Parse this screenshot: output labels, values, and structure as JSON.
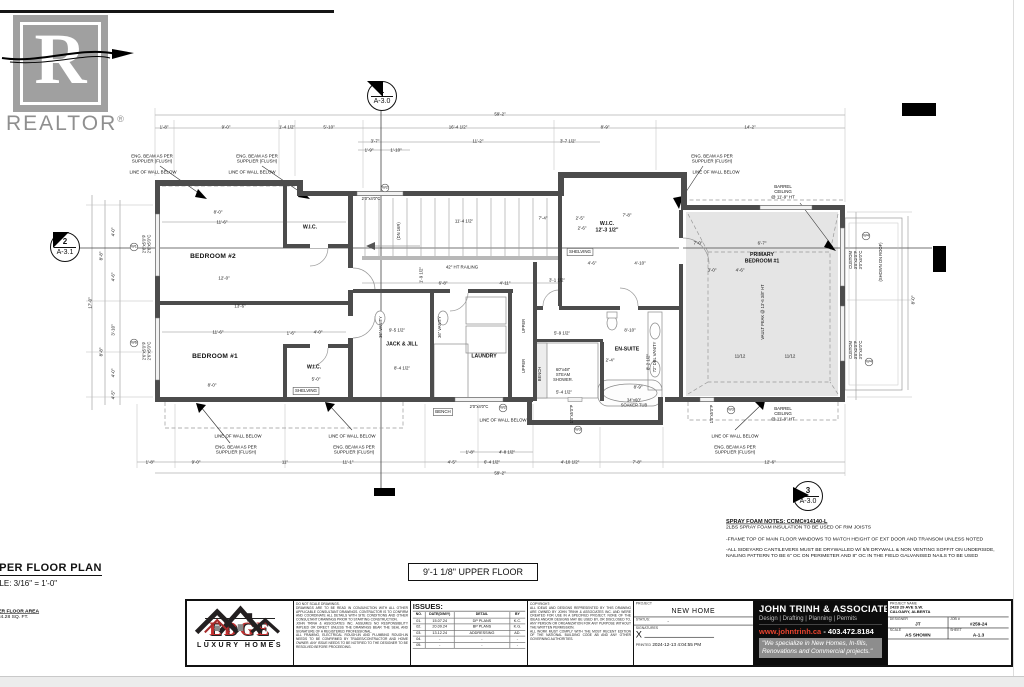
{
  "watermark": {
    "brand": "REALTOR",
    "reg": "®",
    "letter": "R"
  },
  "section_markers": [
    {
      "num": "1",
      "sheet": "A-3.0"
    },
    {
      "num": "2",
      "sheet": "A-3.1"
    },
    {
      "num": "3",
      "sheet": "A-3.0"
    }
  ],
  "plan": {
    "labels": [
      {
        "t": "59'-2\"",
        "x": 500,
        "y": 114
      },
      {
        "t": "1'-8\"",
        "x": 164,
        "y": 127
      },
      {
        "t": "9'-0\"",
        "x": 226,
        "y": 127
      },
      {
        "t": "1'-4 1/2\"",
        "x": 287,
        "y": 127
      },
      {
        "t": "5'-10\"",
        "x": 329,
        "y": 127
      },
      {
        "t": "16'-4 1/2\"",
        "x": 458,
        "y": 127
      },
      {
        "t": "8'-9\"",
        "x": 605,
        "y": 127
      },
      {
        "t": "14'-2\"",
        "x": 750,
        "y": 127
      },
      {
        "t": "3'-7\"",
        "x": 375,
        "y": 141
      },
      {
        "t": "11'-2\"",
        "x": 478,
        "y": 141
      },
      {
        "t": "3'-7 1/2\"",
        "x": 568,
        "y": 141
      },
      {
        "t": "1'-9\"",
        "x": 369,
        "y": 150
      },
      {
        "t": "1'-10\"",
        "x": 396,
        "y": 150
      },
      {
        "t": "1'-8\"",
        "x": 150,
        "y": 462
      },
      {
        "t": "9'-0\"",
        "x": 196,
        "y": 462
      },
      {
        "t": "11\"",
        "x": 285,
        "y": 462
      },
      {
        "t": "11'-1\"",
        "x": 348,
        "y": 462
      },
      {
        "t": "4'-5\"",
        "x": 452,
        "y": 462
      },
      {
        "t": "6'-4 1/2\"",
        "x": 492,
        "y": 462
      },
      {
        "t": "4'-10 1/2\"",
        "x": 570,
        "y": 462
      },
      {
        "t": "7'-8\"",
        "x": 637,
        "y": 462
      },
      {
        "t": "12'-6\"",
        "x": 770,
        "y": 462
      },
      {
        "t": "1'-8\"",
        "x": 470,
        "y": 452
      },
      {
        "t": "4'-8 1/2\"",
        "x": 507,
        "y": 452
      },
      {
        "t": "59'-2\"",
        "x": 500,
        "y": 473
      },
      {
        "t": "4'-0\"",
        "x": 113,
        "y": 232,
        "r": 1
      },
      {
        "t": "8'-8\"",
        "x": 101,
        "y": 256,
        "r": 1
      },
      {
        "t": "4'-6\"",
        "x": 113,
        "y": 277,
        "r": 1
      },
      {
        "t": "17'-0\"",
        "x": 90,
        "y": 303,
        "r": 1
      },
      {
        "t": "3'-10\"",
        "x": 113,
        "y": 330,
        "r": 1
      },
      {
        "t": "8'-8\"",
        "x": 101,
        "y": 352,
        "r": 1
      },
      {
        "t": "4'-0\"",
        "x": 113,
        "y": 373,
        "r": 1
      },
      {
        "t": "4'-5\"",
        "x": 113,
        "y": 395,
        "r": 1
      },
      {
        "t": "8'-0\"",
        "x": 913,
        "y": 300,
        "r": 1
      },
      {
        "t": "8'-0\"",
        "x": 218,
        "y": 212
      },
      {
        "t": "11'-6\"",
        "x": 222,
        "y": 222
      },
      {
        "t": "12'-0\"",
        "x": 224,
        "y": 278
      },
      {
        "t": "13'-6\"",
        "x": 240,
        "y": 306
      },
      {
        "t": "11'-6\"",
        "x": 218,
        "y": 332
      },
      {
        "t": "8'-0\"",
        "x": 212,
        "y": 385
      },
      {
        "t": "1'-6\"",
        "x": 291,
        "y": 333
      },
      {
        "t": "4'-0\"",
        "x": 318,
        "y": 332
      },
      {
        "t": "5'-0\"",
        "x": 316,
        "y": 379
      },
      {
        "t": "11'-4 1/2\"",
        "x": 464,
        "y": 221
      },
      {
        "t": "7'-4\"",
        "x": 543,
        "y": 218
      },
      {
        "t": "2'-5\"",
        "x": 580,
        "y": 218
      },
      {
        "t": "2'-6\"",
        "x": 582,
        "y": 228
      },
      {
        "t": "6'-8\"",
        "x": 443,
        "y": 283
      },
      {
        "t": "4'-11\"",
        "x": 505,
        "y": 283
      },
      {
        "t": "3'-1 1/2\"",
        "x": 557,
        "y": 280
      },
      {
        "t": "1'-9 1/2\"",
        "x": 421,
        "y": 275,
        "r": 1
      },
      {
        "t": "9'-5 1/2\"",
        "x": 397,
        "y": 330
      },
      {
        "t": "8'-4 1/2\"",
        "x": 402,
        "y": 368
      },
      {
        "t": "7'-8\"",
        "x": 627,
        "y": 215
      },
      {
        "t": "4'-6\"",
        "x": 592,
        "y": 263
      },
      {
        "t": "4'-10\"",
        "x": 640,
        "y": 263
      },
      {
        "t": "5'-9 1/2\"",
        "x": 562,
        "y": 333
      },
      {
        "t": "8'-10\"",
        "x": 630,
        "y": 330
      },
      {
        "t": "2'-4\"",
        "x": 610,
        "y": 360
      },
      {
        "t": "8'-9\"",
        "x": 638,
        "y": 387
      },
      {
        "t": "5'-4 1/2\"",
        "x": 564,
        "y": 392
      },
      {
        "t": "8'-2 1/2\"",
        "x": 648,
        "y": 362,
        "r": 1
      },
      {
        "t": "7'-0\"",
        "x": 698,
        "y": 243
      },
      {
        "t": "6'-7\"",
        "x": 762,
        "y": 243
      },
      {
        "t": "3'-0\"",
        "x": 712,
        "y": 270
      },
      {
        "t": "4'-6\"",
        "x": 740,
        "y": 270
      },
      {
        "t": "11/12",
        "x": 740,
        "y": 356
      },
      {
        "t": "11/12",
        "x": 790,
        "y": 356
      },
      {
        "t": "2'6\"x5'0\"P\n2'6\"x5'0\"C",
        "x": 147,
        "y": 244,
        "k": "win",
        "r": 1
      },
      {
        "t": "2'6\"x5'0\"P\n2'6\"x5'0\"C",
        "x": 147,
        "y": 351,
        "k": "win",
        "r": 1
      },
      {
        "t": "W1",
        "x": 134,
        "y": 247,
        "k": "wc"
      },
      {
        "t": "W6",
        "x": 134,
        "y": 343,
        "k": "wc"
      },
      {
        "t": "2'0\"x4'0\"C",
        "x": 371,
        "y": 199,
        "k": "win"
      },
      {
        "t": "W2",
        "x": 385,
        "y": 188,
        "k": "wc"
      },
      {
        "t": "2'0\"x4'0\"C",
        "x": 479,
        "y": 407,
        "k": "win"
      },
      {
        "t": "W2",
        "x": 503,
        "y": 408,
        "k": "wc"
      },
      {
        "t": "1'0\"x5'0\"P",
        "x": 572,
        "y": 414,
        "k": "win",
        "r": 1
      },
      {
        "t": "W3",
        "x": 578,
        "y": 430,
        "k": "wc"
      },
      {
        "t": "1'0\"x5'0\"P",
        "x": 712,
        "y": 414,
        "k": "win",
        "r": 1
      },
      {
        "t": "W3",
        "x": 731,
        "y": 410,
        "k": "wc"
      },
      {
        "t": "CUSTOM\n3'0\"x2'0\"P\n3'0\"x4'0\"C",
        "x": 856,
        "y": 260,
        "k": "win",
        "r": 1
      },
      {
        "t": "W4",
        "x": 866,
        "y": 236,
        "k": "wc"
      },
      {
        "t": "CUSTOM\n3'0\"x2'0\"P\n3'0\"x4'0\"C",
        "x": 856,
        "y": 350,
        "k": "win",
        "r": 1
      },
      {
        "t": "W4",
        "x": 869,
        "y": 362,
        "k": "wc"
      },
      {
        "t": "(SHOWN ON ROOF)",
        "x": 881,
        "y": 262,
        "k": "win",
        "r": 1
      },
      {
        "t": "BEDROOM #2",
        "x": 213,
        "y": 256,
        "k": "room"
      },
      {
        "t": "BEDROOM #1",
        "x": 215,
        "y": 356,
        "k": "room"
      },
      {
        "t": "W.I.C.",
        "x": 310,
        "y": 227,
        "k": "room2"
      },
      {
        "t": "W.I.C.",
        "x": 314,
        "y": 367,
        "k": "room2"
      },
      {
        "t": "SHELVING",
        "x": 306,
        "y": 391,
        "k": "box"
      },
      {
        "t": "JACK & JILL",
        "x": 402,
        "y": 344,
        "k": "room2"
      },
      {
        "t": "LAUNDRY",
        "x": 484,
        "y": 356,
        "k": "room2"
      },
      {
        "t": "EN-SUITE",
        "x": 627,
        "y": 349,
        "k": "room2"
      },
      {
        "t": "W.I.C.\n12'-3 1/2\"",
        "x": 607,
        "y": 227,
        "k": "room2"
      },
      {
        "t": "SHELVING",
        "x": 580,
        "y": 252,
        "k": "box"
      },
      {
        "t": "PRIMARY\nBEDROOM #1",
        "x": 762,
        "y": 258,
        "k": "room2"
      },
      {
        "t": "BENCH",
        "x": 443,
        "y": 412,
        "k": "box"
      },
      {
        "t": "BENCH",
        "x": 540,
        "y": 374,
        "k": "fix",
        "r": 1
      },
      {
        "t": "UPPER",
        "x": 524,
        "y": 326,
        "k": "fix",
        "r": 1
      },
      {
        "t": "UPPER",
        "x": 524,
        "y": 366,
        "k": "fix",
        "r": 1
      },
      {
        "t": "36\" VANITY",
        "x": 381,
        "y": 327,
        "k": "fix",
        "r": 1
      },
      {
        "t": "36\" VANITY",
        "x": 440,
        "y": 327,
        "k": "fix",
        "r": 1
      },
      {
        "t": "72\" DBL VANITY",
        "x": 655,
        "y": 357,
        "k": "fix",
        "r": 1
      },
      {
        "t": "60\"x48\"\nSTEAM\nSHOWER.",
        "x": 563,
        "y": 375,
        "k": "fix"
      },
      {
        "t": "34\"x60\"\nSOAKER TUB",
        "x": 634,
        "y": 403,
        "k": "fix"
      },
      {
        "t": "42\" HT RAILING",
        "x": 462,
        "y": 267,
        "k": "ann"
      },
      {
        "t": "(DN 16R)",
        "x": 399,
        "y": 231,
        "k": "fix",
        "r": 1
      },
      {
        "t": "BARREL\nCEILING\n@ 11'-9\" HT",
        "x": 783,
        "y": 192,
        "k": "ann"
      },
      {
        "t": "BARREL\nCEILING\n@ 11'-9\" HT",
        "x": 783,
        "y": 414,
        "k": "ann"
      },
      {
        "t": "VAULT PEAK @ 13'-6 3/8\" HT",
        "x": 763,
        "y": 312,
        "k": "fix",
        "r": 1
      },
      {
        "t": "ENG. BEAM AS PER\nSUPPLIER (FLUSH)",
        "x": 152,
        "y": 159,
        "k": "ann"
      },
      {
        "t": "ENG. BEAM AS PER\nSUPPLIER (FLUSH)",
        "x": 257,
        "y": 159,
        "k": "ann"
      },
      {
        "t": "LINE OF WALL BELOW",
        "x": 153,
        "y": 172,
        "k": "ann"
      },
      {
        "t": "LINE OF WALL BELOW",
        "x": 252,
        "y": 172,
        "k": "ann"
      },
      {
        "t": "ENG. BEAM AS PER\nSUPPLIER (FLUSH)",
        "x": 712,
        "y": 159,
        "k": "ann"
      },
      {
        "t": "LINE OF WALL BELOW",
        "x": 716,
        "y": 172,
        "k": "ann"
      },
      {
        "t": "LINE OF WALL BELOW",
        "x": 238,
        "y": 436,
        "k": "ann"
      },
      {
        "t": "ENG. BEAM AS PER\nSUPPLIER (FLUSH)",
        "x": 236,
        "y": 450,
        "k": "ann"
      },
      {
        "t": "LINE OF WALL BELOW",
        "x": 352,
        "y": 436,
        "k": "ann"
      },
      {
        "t": "ENG. BEAM AS PER\nSUPPLIER (FLUSH)",
        "x": 354,
        "y": 450,
        "k": "ann"
      },
      {
        "t": "LINE OF WALL BELOW",
        "x": 503,
        "y": 420,
        "k": "ann"
      },
      {
        "t": "LINE OF WALL BELOW",
        "x": 735,
        "y": 436,
        "k": "ann"
      },
      {
        "t": "ENG. BEAM AS PER\nSUPPLIER (FLUSH)",
        "x": 735,
        "y": 450,
        "k": "ann"
      }
    ]
  },
  "notes": {
    "title": "SPRAY FOAM NOTES: CCMC#14140-L",
    "paras": [
      "2LBS SPRAY FOAM INSULATION TO BE USED OF RIM JOISTS",
      "-FRAME TOP OF MAIN FLOOR WINDOWS TO MATCH HEIGHT OF EXT DOOR AND TRANSOM UNLESS NOTED",
      "-ALL SIDEYARD CANTILEVERS MUST BE DRYWALLED W/ 5/8 DRYWALL & NON VENTING SOFFIT ON UNDERSIDE, NAILING PATTERN TO BE 6\" OC ON PERIMETER AND 8\" OC IN THE FIELD GALVANISED NAILS TO BE USED"
    ]
  },
  "plan_title": {
    "title": "UPPER FLOOR PLAN",
    "scale": "SCALE: 3/16\" = 1'-0\"",
    "elevation_box": "9'-1 1/8\" UPPER FLOOR",
    "area_label": "UPPER FLOOR AREA",
    "area_value": "= 1084.28 SQ. FT."
  },
  "logo": {
    "name": "EDGE",
    "tagline": "LUXURY HOMES"
  },
  "titleblock": {
    "disclaimer": "DO NOT SCALE DRAWINGS.\nDRAWINGS ARE TO BE READ IN CONJUNCTION WITH ALL OTHER APPLICABLE CONSULTANT DRAWINGS. CONTRACTOR IS TO CONFIRM AND COORDINATE ALL DETAILS WITH SITE CONDITIONS AND OTHER CONSULTANT DRAWINGS PRIOR TO STARTING CONSTRUCTION.\nJOHN TRINH & ASSOCIATES INC. ASSUMES NO RESPONSIBILITY IMPLIED OR DIRECT UNLESS THE DRAWINGS BEAR THE SEAL AND SIGNATURE OF A REGISTERED PROFESSIONAL.\nALL FRAMING, ELECTRICAL ROUGH-IN AND PLUMBING ROUGH-IN NEEDS TO BE CONFIRMED BY TRADES/CONTRACTOR AND HOME OWNER. ANY ISSUE NEEDS TO BE NOTIFIED TO THE DESIGNER TO BE RESOLVED BEFORE PROCEEDING.",
    "issues": {
      "title": "ISSUES:",
      "headers": [
        "NO.",
        "DATE(D/M/Y)",
        "DETAIL",
        "BY"
      ],
      "rows": [
        [
          "01.",
          "15.07.24",
          "DP PLANS",
          "K.C."
        ],
        [
          "02.",
          "20.09.24",
          "BP PLANS",
          "K.G."
        ],
        [
          "03.",
          "13.12.24",
          "ADDRESSING",
          "AD."
        ],
        [
          "04.",
          "-",
          "-",
          "-"
        ],
        [
          "05.",
          "-",
          "-",
          "-"
        ]
      ]
    },
    "copyright": "COPYRIGHT:\nALL IDEAS AND DESIGNS REPRESENTED BY THIS DRAWING ARE OWNED BY JOHN TRINH & ASSOCIATES INC. AND WERE CREATED FOR USE IN A SPECIFIED PROJECT. NONE OF THE IDEAS AND/OR DESIGNS MAY BE USED BY, OR DISCLOSED TO, ANY PERSON OR ORGANIZATION FOR ANY PURPOSE WITHOUT THE WRITTEN PERMISSION.\nALL WORK MUST COMPLY WITH THE MOST RECENT EDITION OF THE NATIONAL BUILDING CODE AB AND ANY OTHER GOVERNING AUTHORITIES.",
    "project_label": "PROJECT",
    "project": "NEW HOME",
    "status_label": "STATUS:",
    "status": "-",
    "signatures_label": "SIGNATURES",
    "signature_x": "X",
    "printed_label": "PRINTED",
    "printed": "2024-12-13 4:04:55 PM",
    "firm": {
      "name": "JOHN TRINH",
      "assoc": "& ASSOCIATES",
      "tagline": "Design | Drafting | Planning | Permits",
      "web": "www.johntrinh.ca",
      "sep": " - ",
      "phone": "403.472.8184",
      "quote": "\"We specialize in New Homes, In-fills, Renovations and Commercial projects.\""
    },
    "project_name_label": "PROJECT NAME",
    "address1": "2428 29 AVE S.W.",
    "address2": "CALGARY, ALBERTA",
    "designer_label": "DESIGNER",
    "designer": "JT",
    "job_label": "JOB #",
    "job": "#259-24",
    "scale_label": "SCALE",
    "scale": "AS SHOWN",
    "sheet_label": "SHEET",
    "sheet": "A-1.3"
  }
}
